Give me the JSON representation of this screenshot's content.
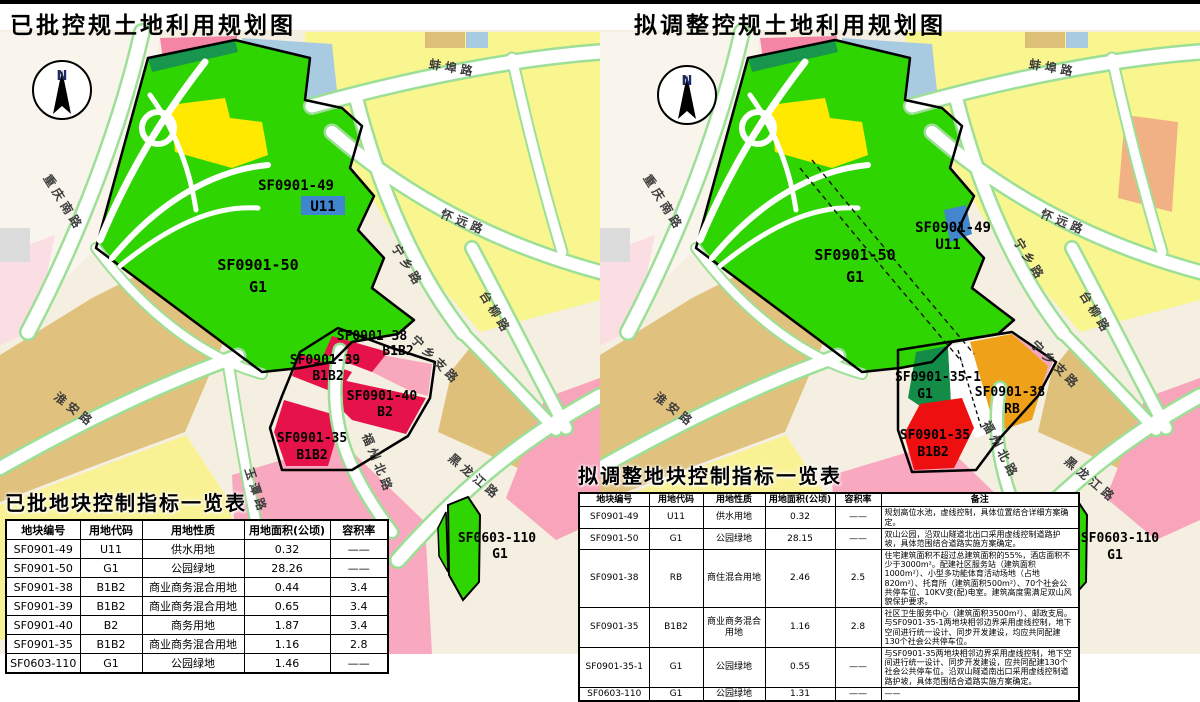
{
  "titles": {
    "left": "已批控规土地利用规划图",
    "right": "拟调整控规土地利用规划图"
  },
  "compass": {
    "label": "N"
  },
  "roads": {
    "bengbu": "蚌埠路",
    "huaiyuan": "怀远路",
    "chongqingnan": "重庆南路",
    "huaian": "淮安路",
    "ningxiang": "宁乡路",
    "tailiu": "台柳路",
    "ningxiangzhi": "宁乡支路",
    "fuzhoubei": "福州北路",
    "yutan": "玉潭路",
    "heilongjiang": "黑龙江路"
  },
  "colors": {
    "park_green": "#2fd500",
    "protect_green": "#18964e",
    "commerce_red": "#e5134a",
    "pure_red": "#ee1010",
    "mixed_orange": "#efa11a",
    "water_blue": "#3f86cf",
    "residential_yellow": "#f9f690",
    "village_tan": "#e0c17d",
    "pink": "#f9a9bf"
  },
  "left_map": {
    "parcels": {
      "sf0901_49": {
        "code": "SF0901-49",
        "use": "U11"
      },
      "sf0901_50": {
        "code": "SF0901-50",
        "use": "G1"
      },
      "sf0901_38": {
        "code": "SF0901-38",
        "use": "B1B2"
      },
      "sf0901_39": {
        "code": "SF0901-39",
        "use": "B1B2"
      },
      "sf0901_40": {
        "code": "SF0901-40",
        "use": "B2"
      },
      "sf0901_35": {
        "code": "SF0901-35",
        "use": "B1B2"
      },
      "sf0603_110": {
        "code": "SF0603-110",
        "use": "G1"
      }
    },
    "table": {
      "title": "已批地块控制指标一览表",
      "headers": [
        "地块编号",
        "用地代码",
        "用地性质",
        "用地面积(公顷)",
        "容积率"
      ],
      "rows": [
        [
          "SF0901-49",
          "U11",
          "供水用地",
          "0.32",
          "——"
        ],
        [
          "SF0901-50",
          "G1",
          "公园绿地",
          "28.26",
          "——"
        ],
        [
          "SF0901-38",
          "B1B2",
          "商业商务混合用地",
          "0.44",
          "3.4"
        ],
        [
          "SF0901-39",
          "B1B2",
          "商业商务混合用地",
          "0.65",
          "3.4"
        ],
        [
          "SF0901-40",
          "B2",
          "商务用地",
          "1.87",
          "3.4"
        ],
        [
          "SF0901-35",
          "B1B2",
          "商业商务混合用地",
          "1.16",
          "2.8"
        ],
        [
          "SF0603-110",
          "G1",
          "公园绿地",
          "1.46",
          "——"
        ]
      ]
    }
  },
  "right_map": {
    "parcels": {
      "sf0901_49": {
        "code": "SF0901-49",
        "use": "U11"
      },
      "sf0901_50": {
        "code": "SF0901-50",
        "use": "G1"
      },
      "sf0901_35_1": {
        "code": "SF0901-35-1",
        "use": "G1"
      },
      "sf0901_38": {
        "code": "SF0901-38",
        "use": "RB"
      },
      "sf0901_35": {
        "code": "SF0901-35",
        "use": "B1B2"
      },
      "sf0603_110": {
        "code": "SF0603-110",
        "use": "G1"
      }
    },
    "table": {
      "title": "拟调整地块控制指标一览表",
      "headers": [
        "地块编号",
        "用地代码",
        "用地性质",
        "用地面积(公顷)",
        "容积率",
        "备注"
      ],
      "rows": [
        [
          "SF0901-49",
          "U11",
          "供水用地",
          "0.32",
          "——",
          "规划高位水池，虚线控制，具体位置结合详细方案确定。"
        ],
        [
          "SF0901-50",
          "G1",
          "公园绿地",
          "28.15",
          "——",
          "双山公园，沿双山隧道北出口采用虚线控制道路护坡，具体范围结合道路实施方案确定。"
        ],
        [
          "SF0901-38",
          "RB",
          "商住混合用地",
          "2.46",
          "2.5",
          "住宅建筑面积不超过总建筑面积的55%，酒店面积不少于3000m²。配建社区服务站（建筑面积1000m²）、小型多功能体育活动场地（占地820m²）、托育所（建筑面积500m²）、70个社会公共停车位、10KV变(配)电室。建筑高度需满足双山风貌保护要求。"
        ],
        [
          "SF0901-35",
          "B1B2",
          "商业商务混合用地",
          "1.16",
          "2.8",
          "社区卫生服务中心（建筑面积3500m²）、邮政支局。与SF0901-35-1两地块相邻边界采用虚线控制，地下空间进行统一设计、同步开发建设，均应共同配建130个社会公共停车位。"
        ],
        [
          "SF0901-35-1",
          "G1",
          "公园绿地",
          "0.55",
          "——",
          "与SF0901-35两地块相邻边界采用虚线控制，地下空间进行统一设计、同步开发建设，应共同配建130个社会公共停车位。沿双山隧道南出口采用虚线控制道路护坡，具体范围结合道路实施方案确定。"
        ],
        [
          "SF0603-110",
          "G1",
          "公园绿地",
          "1.31",
          "——",
          "——"
        ]
      ]
    }
  }
}
